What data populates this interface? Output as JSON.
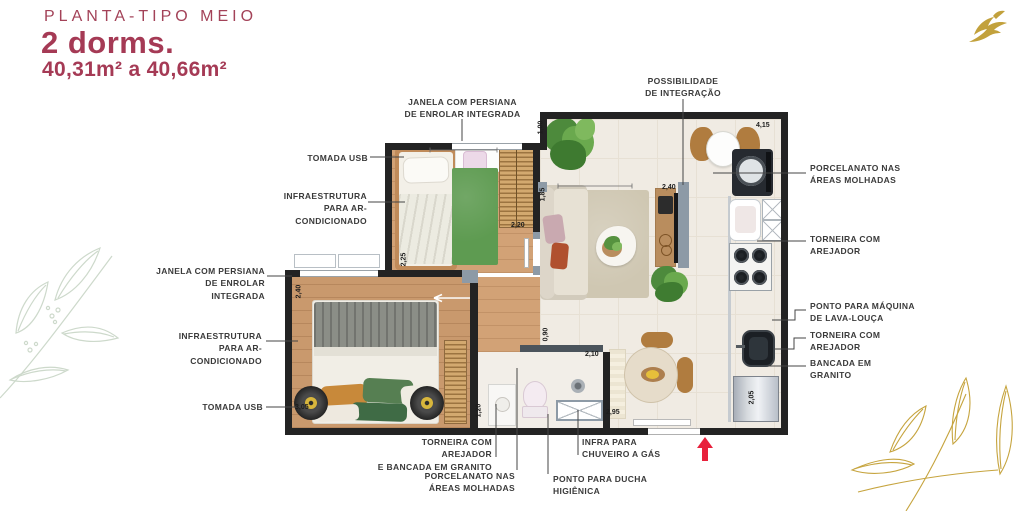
{
  "header": {
    "plan_type": "PLANTA-TIPO MEIO",
    "dorms": "2 dorms.",
    "area_range": "40,31m² a 40,66m²"
  },
  "icons": {
    "logo": "gold-bird",
    "entrance": "red-arrow-up",
    "decor_left": "leaf-line-art-green",
    "decor_right": "leaf-line-art-gold"
  },
  "colors": {
    "accent": "#a53a55",
    "gold": "#c2a13c",
    "arrow_red": "#e8213c",
    "wall": "#232323",
    "tile": "#f0ebe3",
    "wood": "#d2a276",
    "rug_green": "#5e9b51",
    "frame_gray": "#8d9aa6"
  },
  "callouts": {
    "window_top": {
      "text": "JANELA COM PERSIANA\nDE ENROLAR INTEGRADA"
    },
    "usb_top": {
      "text": "TOMADA USB"
    },
    "ac_top": {
      "text": "INFRAESTRUTURA\nPARA AR-CONDICIONADO"
    },
    "window_left": {
      "text": "JANELA COM PERSIANA\nDE ENROLAR INTEGRADA"
    },
    "ac_left": {
      "text": "INFRAESTRUTURA\nPARA AR-CONDICIONADO"
    },
    "usb_left": {
      "text": "TOMADA USB"
    },
    "integration": {
      "text": "POSSIBILIDADE\nDE INTEGRAÇÃO"
    },
    "porcelain_right": {
      "text": "PORCELANATO NAS\nÁREAS MOLHADAS"
    },
    "faucet_right_top": {
      "text": "TORNEIRA COM\nAREJADOR"
    },
    "dishwasher": {
      "text": "PONTO PARA MÁQUINA\nDE LAVA-LOUÇA"
    },
    "faucet_right_bottom": {
      "text": "TORNEIRA COM\nAREJADOR"
    },
    "granite_right": {
      "text": "BANCADA EM\nGRANITO"
    },
    "faucet_bottom": {
      "text": "TORNEIRA COM AREJADOR\nE BANCADA EM GRANITO"
    },
    "porcelain_bottom": {
      "text": "PORCELANATO NAS\nÁREAS MOLHADAS"
    },
    "shower_point": {
      "text": "PONTO PARA DUCHA\nHIGIÊNICA"
    },
    "gas_shower": {
      "text": "INFRA PARA\nCHUVEIRO A GÁS"
    }
  },
  "dimensions": {
    "balcony_depth": "1,00",
    "living_width": "4,15",
    "living_depth": "1,85",
    "tv_wall": "2,40",
    "closet_b1": "2,20",
    "bedroom1_depth": "2,25",
    "bedroom2_depth": "2,40",
    "bedroom2_width": "3,05",
    "hall_width": "0,90",
    "bath_width": "2,10",
    "bath_depth": "1,20",
    "bath_outer": "2,95",
    "kitchen_wall": "2,05"
  }
}
